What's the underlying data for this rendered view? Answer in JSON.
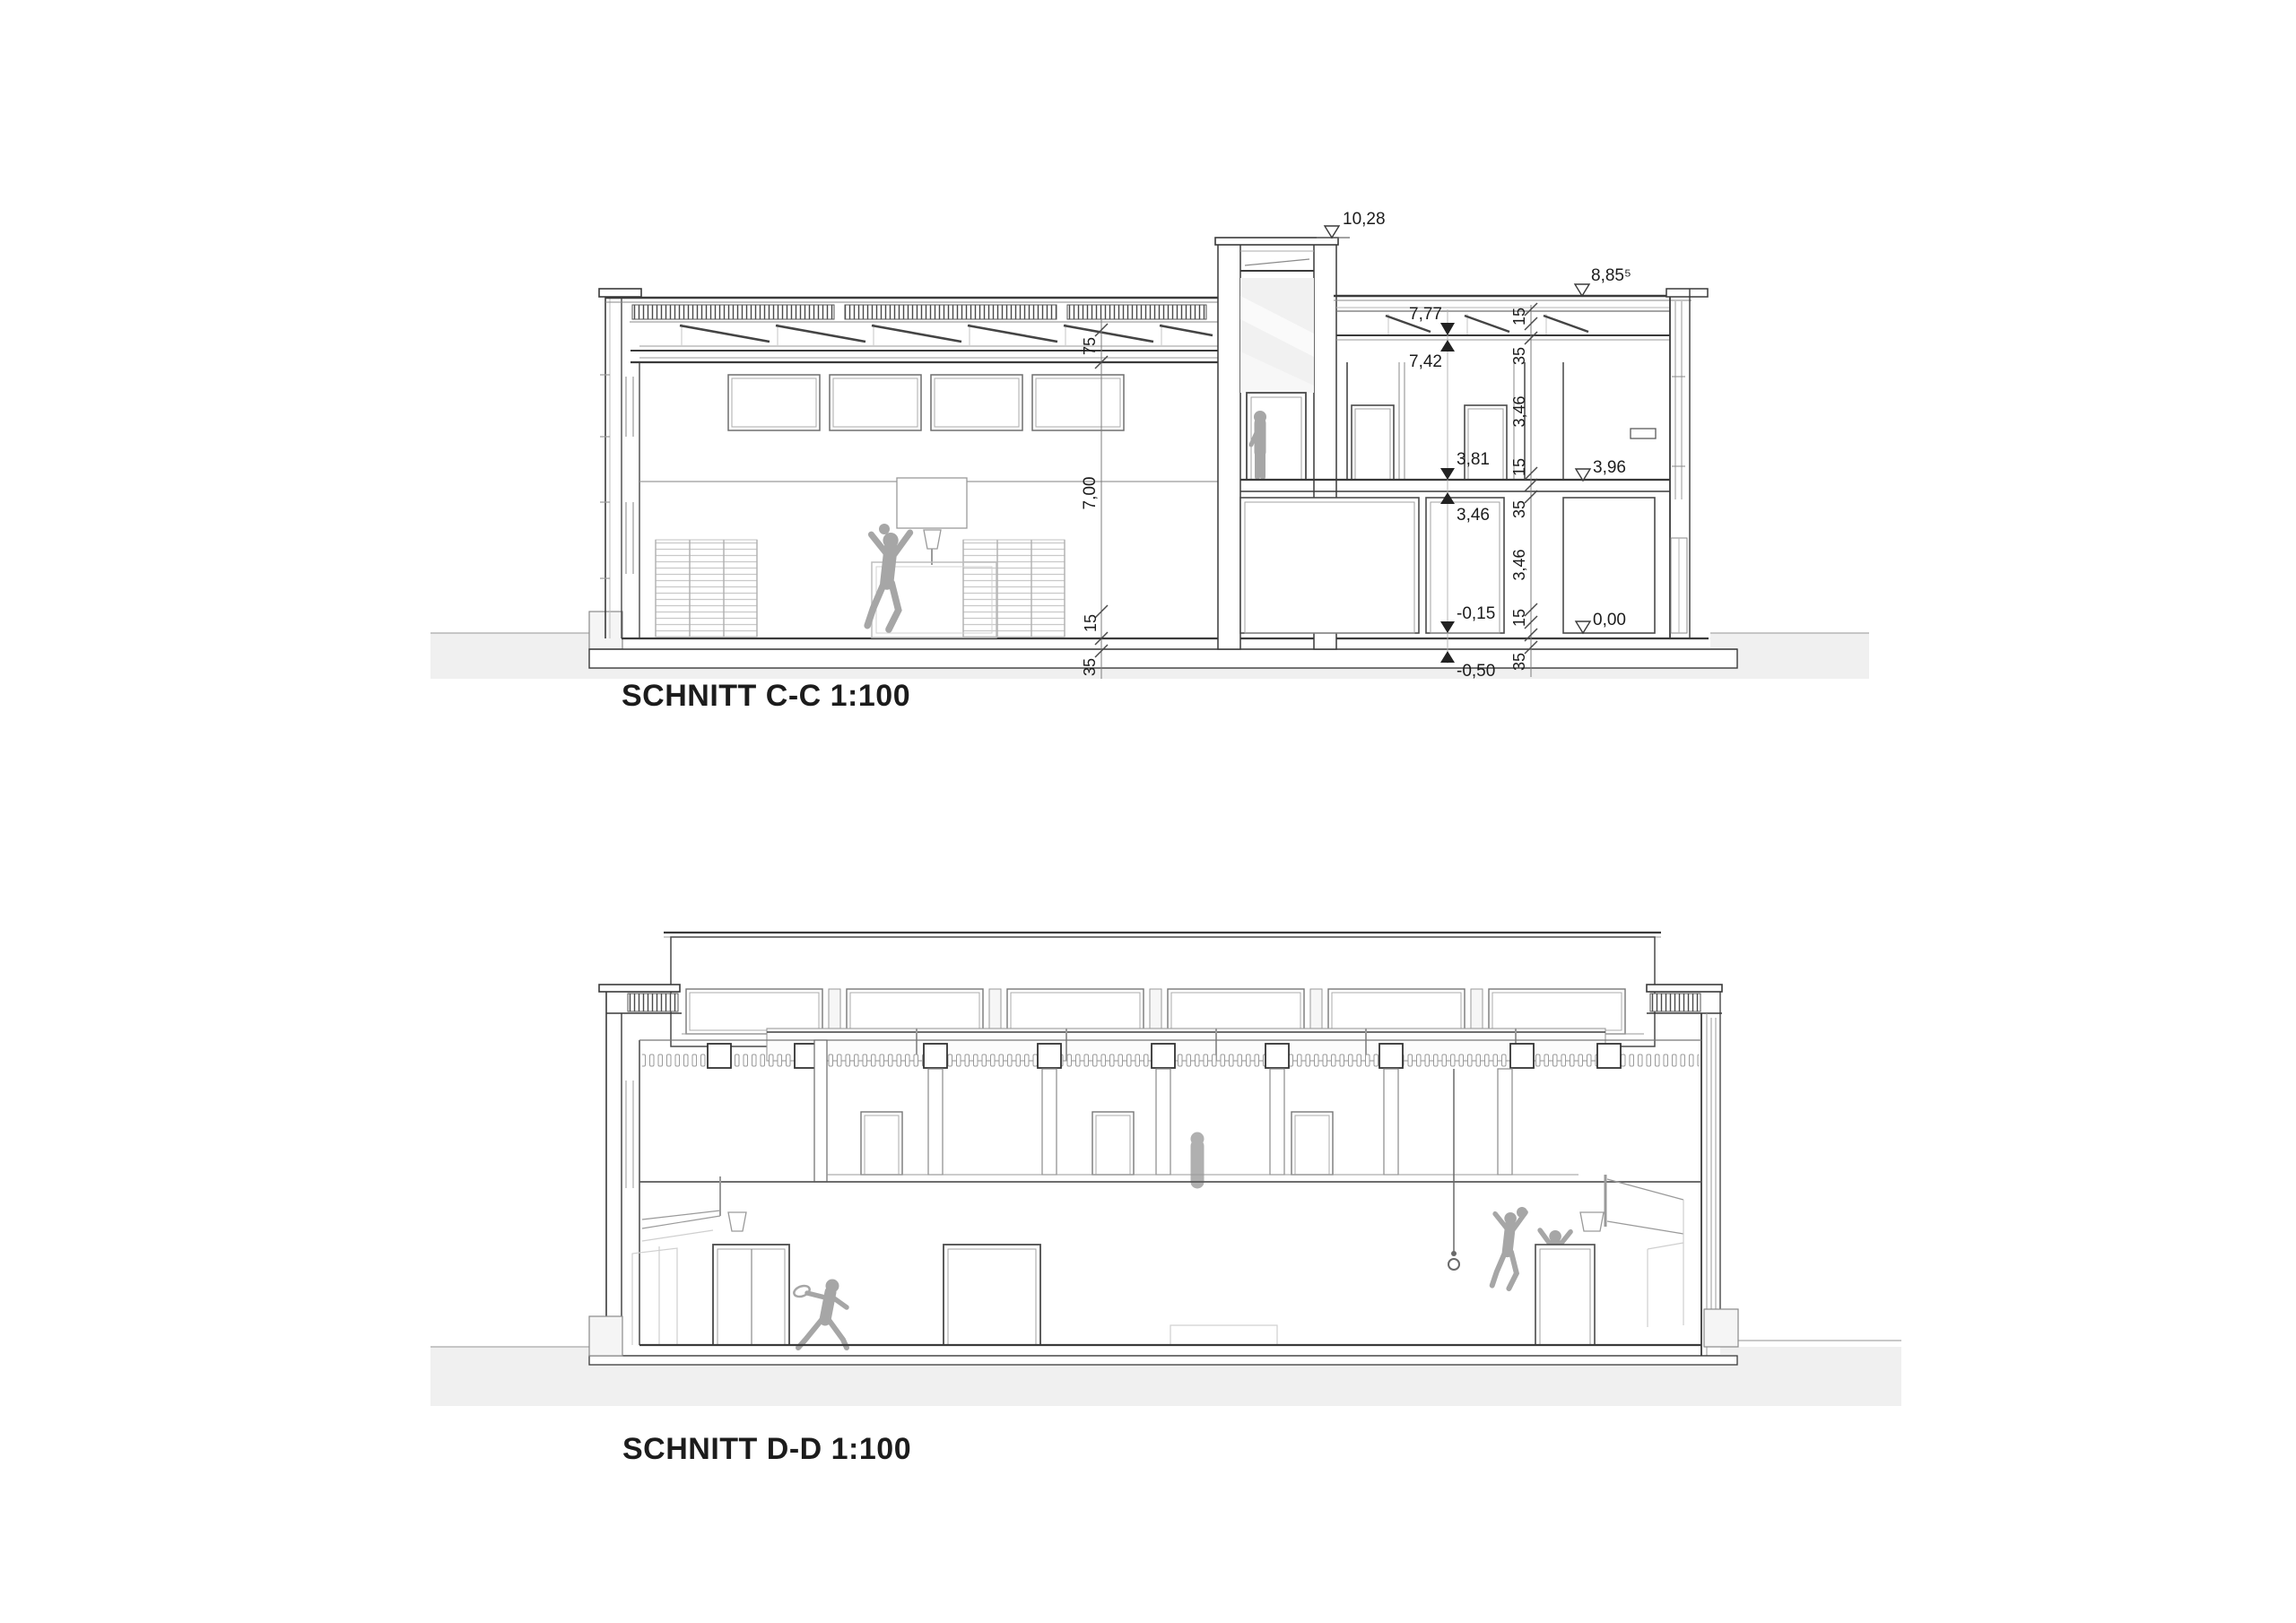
{
  "section_cc": {
    "title": "SCHNITT C-C 1:100",
    "levels": {
      "tower_top": "10,28",
      "roof_right": "8,85⁵",
      "ceiling_under_roof": "7,77",
      "wall_top": "7,42",
      "upper_floor": "3,81",
      "upper_floor_right": "3,96",
      "upper_ceiling": "3,46",
      "ground_floor": "0,00",
      "ground_floor_inner": "-0,15",
      "foundation": "-0,50"
    },
    "dims_hall": {
      "roof": "75",
      "height": "7,00",
      "slab": "15",
      "foundation": "35"
    },
    "dims_right": [
      "15",
      "35",
      "3,46",
      "15",
      "35",
      "3,46",
      "15",
      "35"
    ]
  },
  "section_dd": {
    "title": "SCHNITT D-D 1:100"
  }
}
